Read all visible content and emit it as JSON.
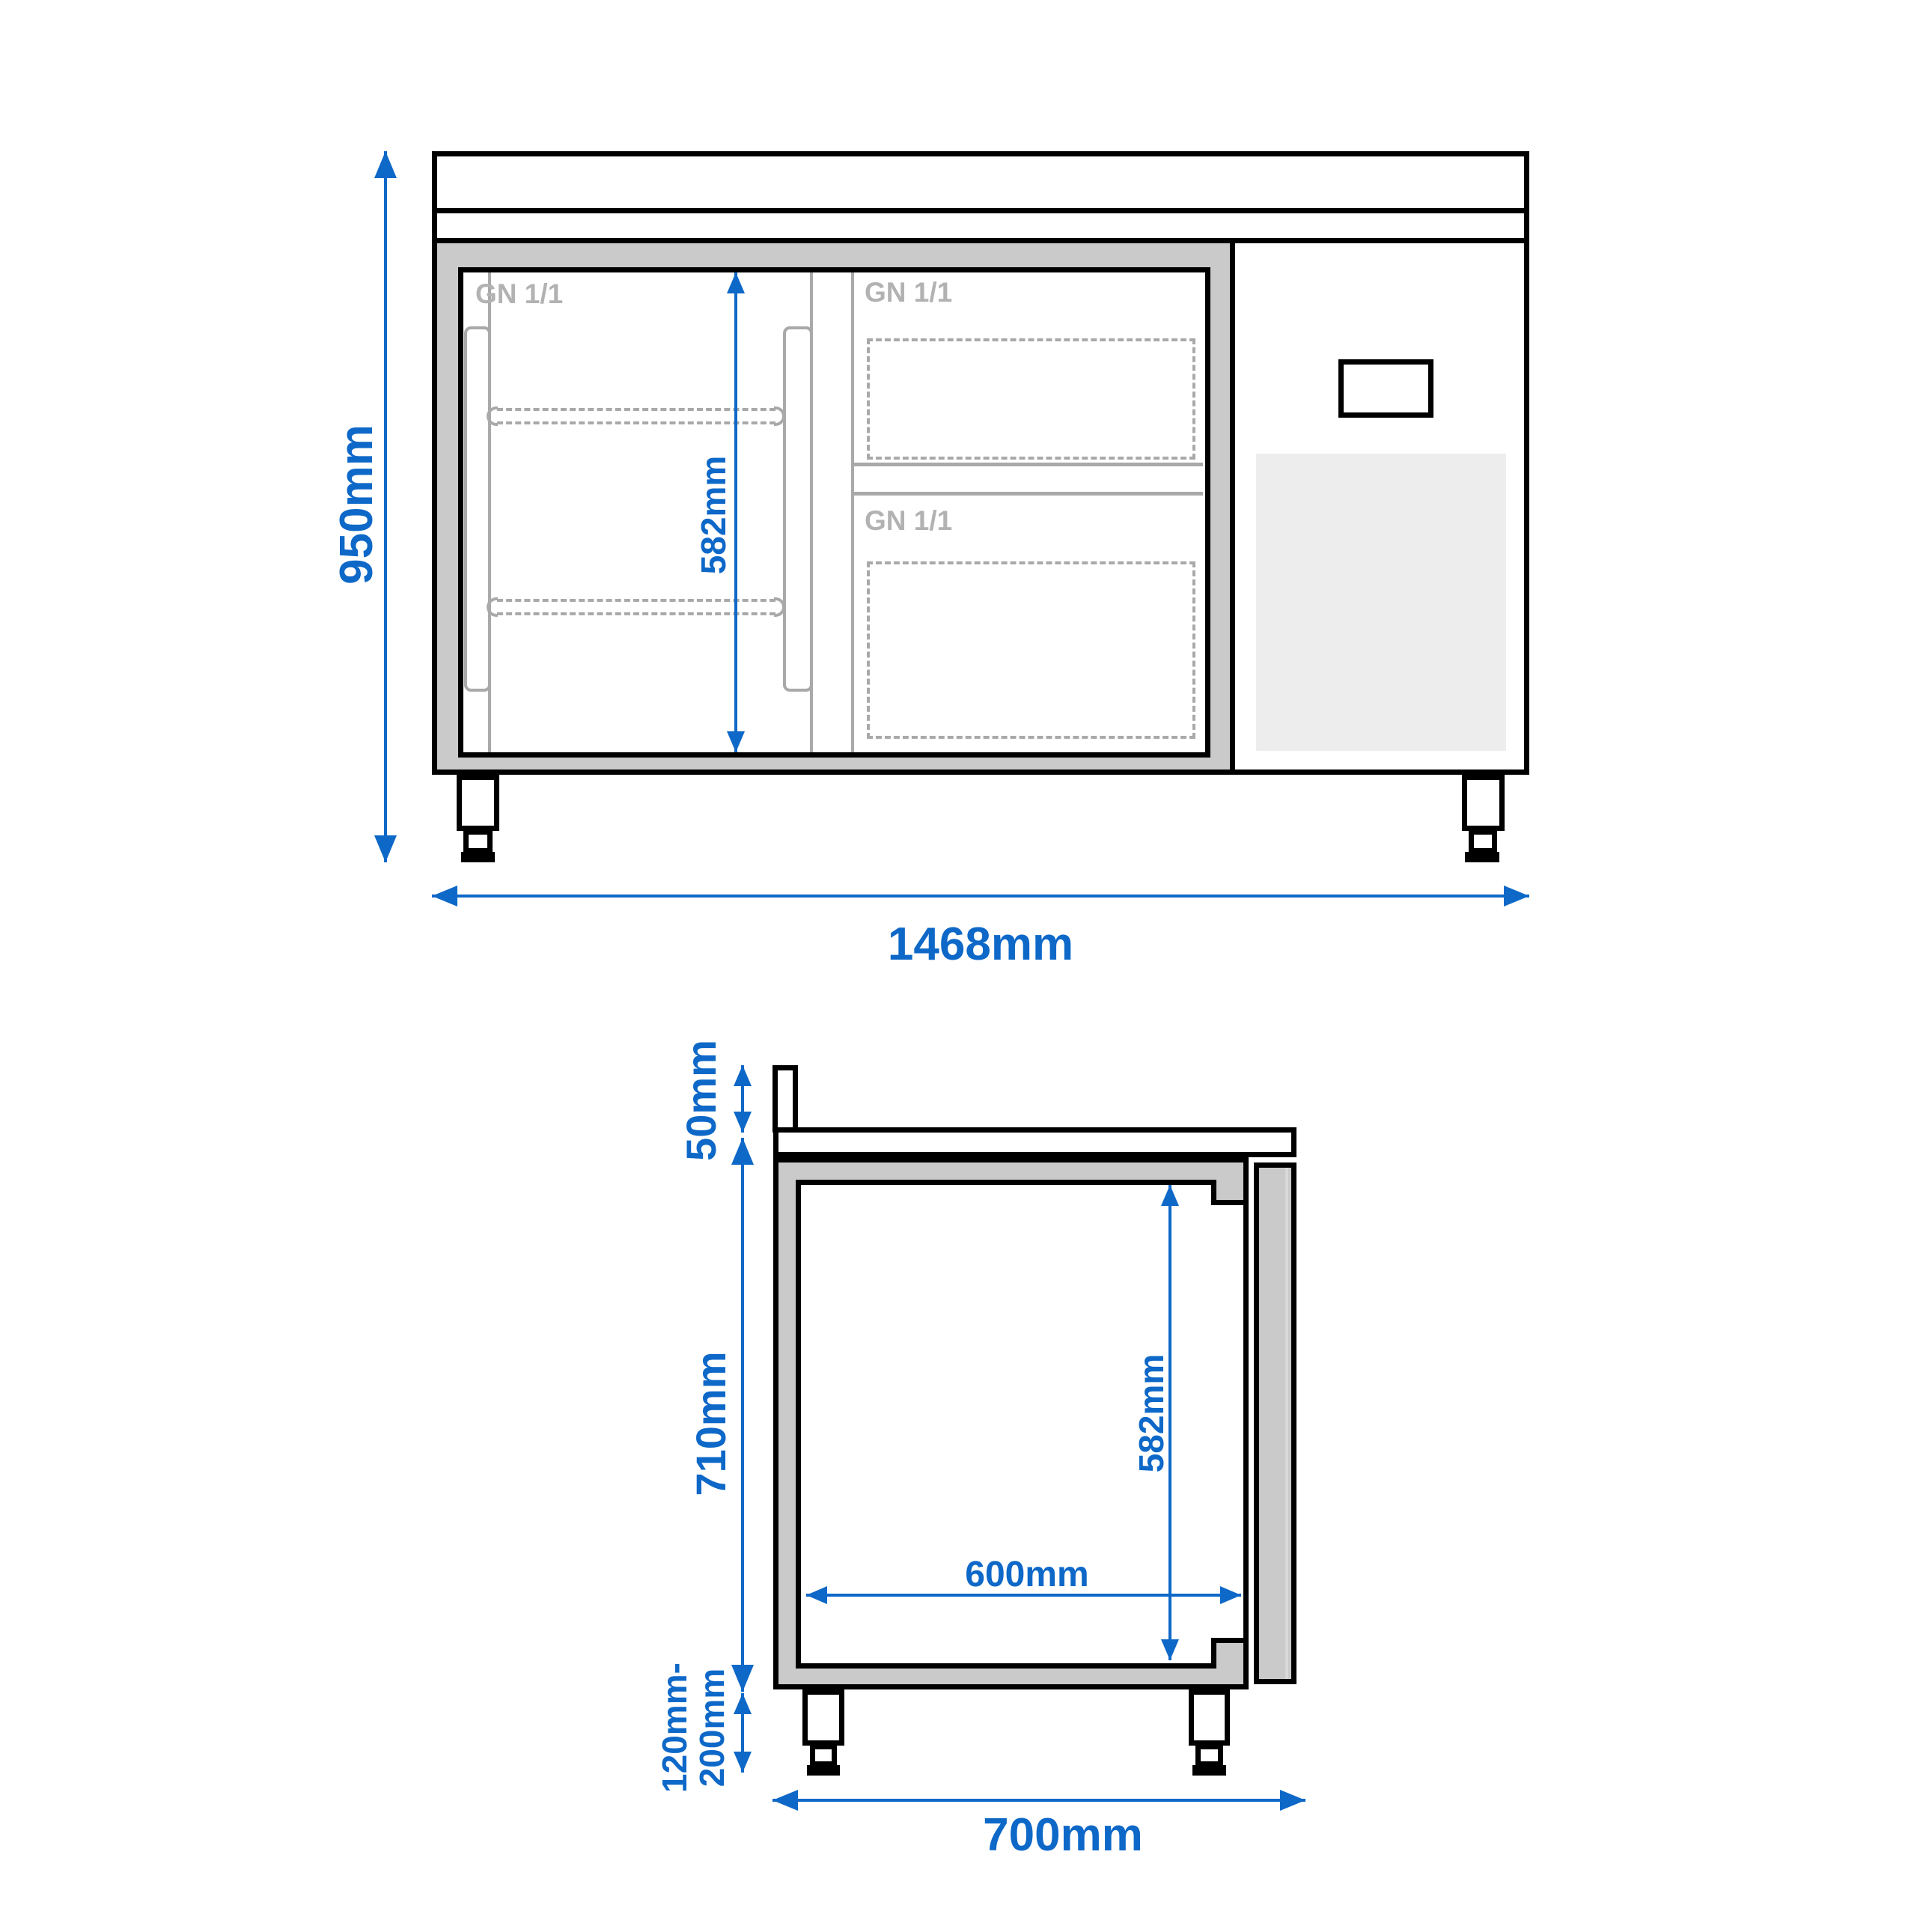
{
  "drawing": {
    "type": "technical-dimension-diagram",
    "subject": "refrigerated counter with door, drawers and cooling unit (front view and side section view)",
    "front_view": {
      "door_label": "GN 1/1",
      "drawer_top_label": "GN 1/1",
      "drawer_bottom_label": "GN 1/1",
      "dim_overall_height": "950mm",
      "dim_interior_height": "582mm",
      "dim_overall_width": "1468mm"
    },
    "side_view": {
      "dim_backsplash_height": "50mm",
      "dim_body_height": "710mm",
      "dim_interior_height": "582mm",
      "dim_interior_depth": "600mm",
      "dim_feet_height_line1": "120mm-",
      "dim_feet_height_line2": "200mm",
      "dim_overall_depth": "700mm"
    },
    "colors": {
      "accent_blue": "#0e68c8",
      "wall_gray": "#cacaca",
      "vent_gray": "#ededed",
      "muted_label_gray": "#b2b2b2",
      "dash_gray": "#a9a9a9",
      "outline_black": "#000000"
    }
  }
}
